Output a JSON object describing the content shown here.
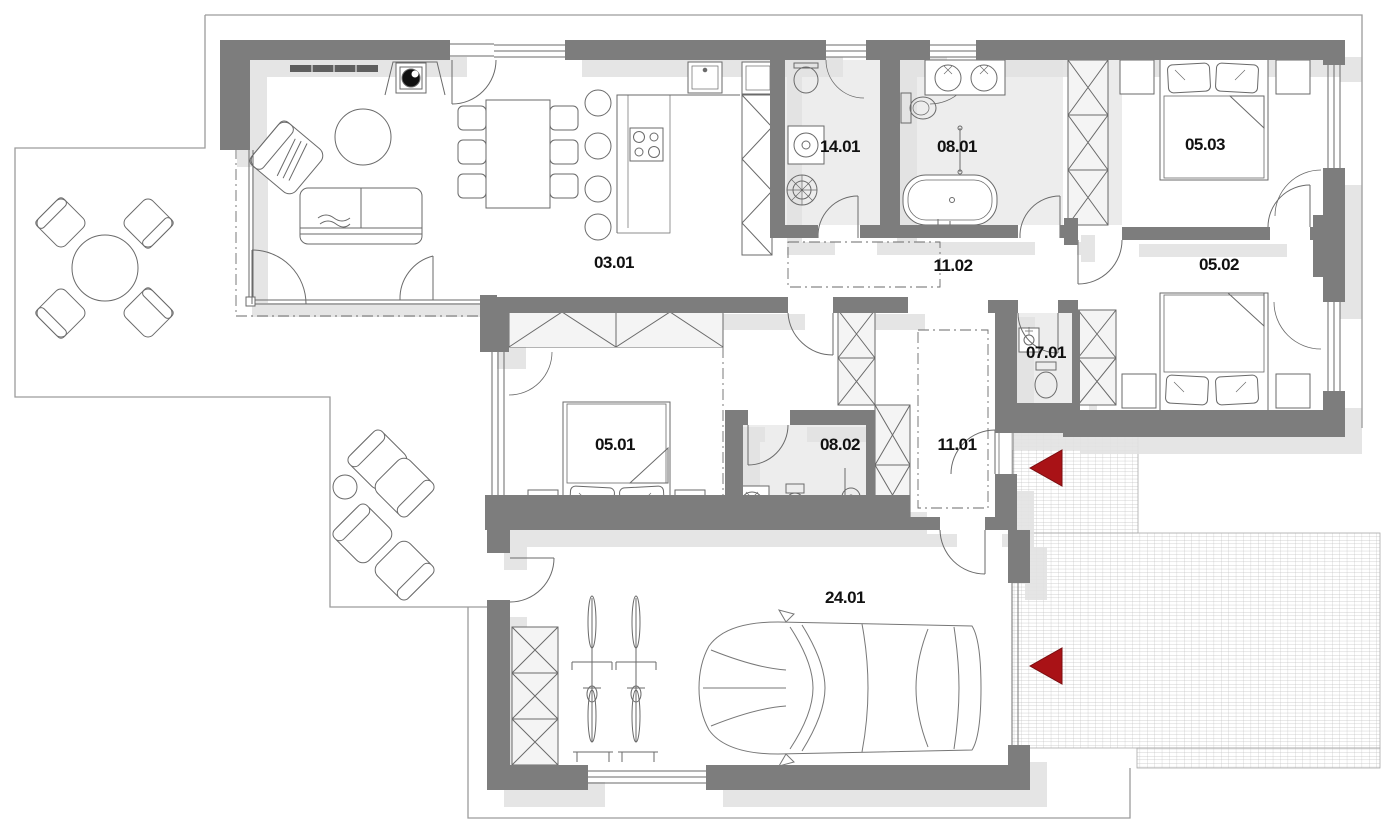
{
  "plan": {
    "title": "apartment-floor-plan",
    "rooms": [
      {
        "id": "03.01",
        "name": "living-room-kitchen"
      },
      {
        "id": "14.01",
        "name": "utility-room"
      },
      {
        "id": "08.01",
        "name": "bathroom-1"
      },
      {
        "id": "05.03",
        "name": "bedroom-3"
      },
      {
        "id": "11.02",
        "name": "hallway-upper"
      },
      {
        "id": "05.02",
        "name": "bedroom-2"
      },
      {
        "id": "07.01",
        "name": "wc"
      },
      {
        "id": "05.01",
        "name": "bedroom-1"
      },
      {
        "id": "08.02",
        "name": "bathroom-2"
      },
      {
        "id": "11.01",
        "name": "entrance-hall"
      },
      {
        "id": "24.01",
        "name": "garage"
      }
    ],
    "colors": {
      "wall": "#7d7d7d",
      "shadow": "#e3e3e3",
      "wet_floor": "#ededed",
      "wardrobe_fill": "#f4f4f4",
      "accent_red": "#a91216",
      "line": "#6a6a6a",
      "outline": "#9c9c9c",
      "paving_line": "#bdbdbd",
      "label": "#111111"
    },
    "icons": [
      "entrance-arrow-icon",
      "car-icon",
      "bicycle-icon",
      "double-bed-icon",
      "sofa-icon",
      "armchair-icon",
      "dining-table-icon",
      "bathtub-icon",
      "toilet-icon",
      "sink-icon",
      "washer-icon",
      "boiler-icon",
      "cooktop-icon",
      "stove-icon",
      "wardrobe-icon",
      "round-table-icon",
      "lounge-chair-icon",
      "shower-icon",
      "garden-table-icon"
    ]
  }
}
